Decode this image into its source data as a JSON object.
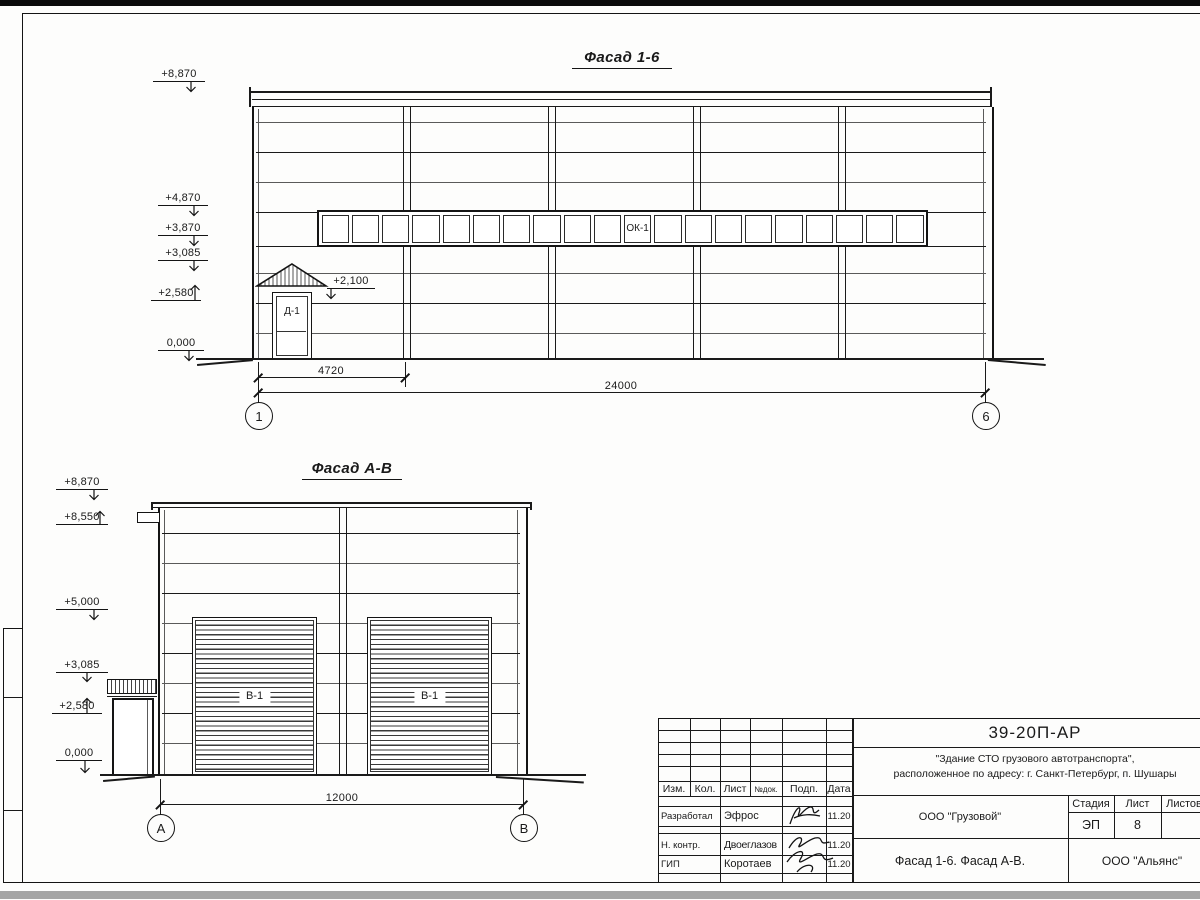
{
  "facade16": {
    "title": "Фасад 1-6",
    "elevations": [
      "+8,870",
      "+4,870",
      "+3,870",
      "+3,085",
      "+2,580",
      "0,000",
      "+2,100"
    ],
    "window_label": "ОК-1",
    "door_label": "Д-1",
    "dims": {
      "bay": "4720",
      "total": "24000"
    },
    "axes": {
      "left": "1",
      "right": "6"
    }
  },
  "facadeAB": {
    "title": "Фасад А-В",
    "elevations": [
      "+8,870",
      "+8,550",
      "+5,000",
      "+3,085",
      "+2,580",
      "0,000"
    ],
    "gate_label": "В-1",
    "dims": {
      "total": "12000"
    },
    "axes": {
      "left": "А",
      "right": "В"
    }
  },
  "titleblock": {
    "doc_number": "39-20П-АР",
    "project_line1": "\"Здание СТО грузового автотранспорта\",",
    "project_line2": "расположенное по адресу: г. Санкт-Петербург, п. Шушары",
    "client": "ООО \"Грузовой\"",
    "sheet_title": "Фасад 1-6. Фасад А-В.",
    "company": "ООО \"Альянс\"",
    "stage_label": "Стадия",
    "sheet_label": "Лист",
    "sheets_label": "Листов",
    "stage_value": "ЭП",
    "sheet_value": "8",
    "header_cols": [
      "Изм.",
      "Кол.",
      "Лист",
      "№док.",
      "Подп.",
      "Дата"
    ],
    "rows": [
      {
        "role": "Разработал",
        "name": "Эфрос",
        "date": "11.20"
      },
      {
        "role": "Н. контр.",
        "name": "Двоеглазов",
        "date": "11.20"
      },
      {
        "role": "ГИП",
        "name": "Коротаев",
        "date": "11.20"
      }
    ]
  }
}
